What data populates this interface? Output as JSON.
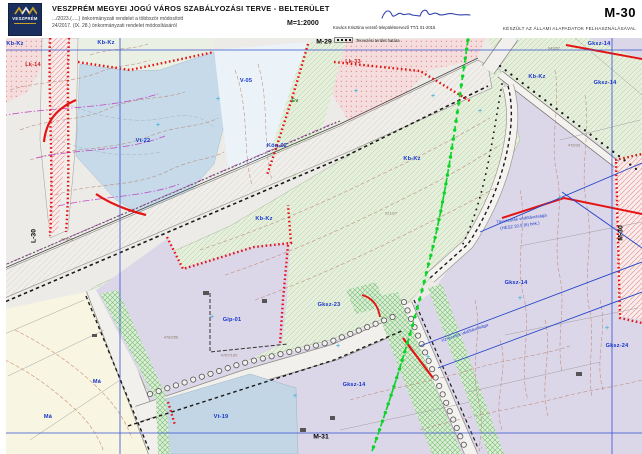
{
  "header": {
    "logo_text": "VESZPRÉM",
    "title": "VESZPRÉM MEGYEI JOGÚ VÁROS SZABÁLYOZÁSI TERVE   -   BELTERÜLET",
    "subtitle1": ".../2023.(.....) önkormányzati rendelet a többször módosított",
    "subtitle2": "24/2017. (IX. 28.) önkormányzati rendelet módosításáról",
    "scale": "M=1:2000",
    "planner": "Kovács Krisztina vezető településtervező   TT/1 01-2015",
    "legend_label": "Tervezési terület határa",
    "sheet_code": "M-30",
    "credit": "KÉSZÜLT AZ ÁLLAMI ALAPADATOK FELHASZNÁLÁSÁVAL"
  },
  "sheet_refs": [
    {
      "text": "M-29",
      "x": 324,
      "y": 42,
      "rot": 0
    },
    {
      "text": "M-31",
      "x": 321,
      "y": 437,
      "rot": 0
    },
    {
      "text": "L-30",
      "x": 34,
      "y": 236,
      "rot": -90
    },
    {
      "text": "M-30",
      "x": 621,
      "y": 233,
      "rot": -90
    }
  ],
  "zone_labels": [
    {
      "text": "Kb-Kz",
      "x": 15,
      "y": 44,
      "c": "blue"
    },
    {
      "text": "Kb-Kz",
      "x": 106,
      "y": 43,
      "c": "blue"
    },
    {
      "text": "Lk-14",
      "x": 33,
      "y": 65,
      "c": "red"
    },
    {
      "text": "Vt-22",
      "x": 143,
      "y": 141,
      "c": "blue"
    },
    {
      "text": "V-05",
      "x": 246,
      "y": 81,
      "c": "blue"
    },
    {
      "text": "Lk-33",
      "x": 353,
      "y": 62,
      "c": "red"
    },
    {
      "text": "Ev",
      "x": 295,
      "y": 101,
      "c": "green"
    },
    {
      "text": "Köu-02",
      "x": 277,
      "y": 146,
      "c": "blue"
    },
    {
      "text": "Kb-Kz",
      "x": 264,
      "y": 219,
      "c": "blue"
    },
    {
      "text": "Kb-Kz",
      "x": 412,
      "y": 159,
      "c": "blue"
    },
    {
      "text": "Kb-Kz",
      "x": 537,
      "y": 77,
      "c": "blue"
    },
    {
      "text": "Gksz-14",
      "x": 599,
      "y": 44,
      "c": "blue"
    },
    {
      "text": "Gksz-14",
      "x": 605,
      "y": 83,
      "c": "blue"
    },
    {
      "text": "Gksz-23",
      "x": 329,
      "y": 305,
      "c": "blue"
    },
    {
      "text": "Gip-01",
      "x": 232,
      "y": 320,
      "c": "blue"
    },
    {
      "text": "Gksz-14",
      "x": 354,
      "y": 385,
      "c": "blue"
    },
    {
      "text": "Gksz-14",
      "x": 516,
      "y": 283,
      "c": "blue"
    },
    {
      "text": "Gksz-24",
      "x": 617,
      "y": 346,
      "c": "blue"
    },
    {
      "text": "Vt-19",
      "x": 221,
      "y": 417,
      "c": "blue"
    },
    {
      "text": "Má",
      "x": 97,
      "y": 382,
      "c": "blue"
    },
    {
      "text": "Má",
      "x": 48,
      "y": 417,
      "c": "blue"
    }
  ],
  "annotations": [
    {
      "text": "Távvezeték védőtávolsága",
      "x": 496,
      "y": 216,
      "rot": -8
    },
    {
      "text": "(HÉSZ 20.§ (6) bek.)",
      "x": 500,
      "y": 223,
      "rot": -8
    },
    {
      "text": "vízvezeték védőtávolsága",
      "x": 440,
      "y": 330,
      "rot": -19
    }
  ],
  "parcel_labels": [
    {
      "text": "478/256",
      "x": 171,
      "y": 337
    },
    {
      "text": "4767/160",
      "x": 229,
      "y": 355
    },
    {
      "text": "476/33",
      "x": 574,
      "y": 145
    },
    {
      "text": "043/57",
      "x": 554,
      "y": 48
    },
    {
      "text": "478/56",
      "x": 67,
      "y": 239
    },
    {
      "text": "0213/7",
      "x": 391,
      "y": 213
    }
  ],
  "survey_marks": [
    {
      "x": 158,
      "y": 126
    },
    {
      "x": 218,
      "y": 100
    },
    {
      "x": 356,
      "y": 92
    },
    {
      "x": 433,
      "y": 97
    },
    {
      "x": 480,
      "y": 112
    },
    {
      "x": 212,
      "y": 318
    },
    {
      "x": 338,
      "y": 347
    },
    {
      "x": 295,
      "y": 397
    },
    {
      "x": 428,
      "y": 358
    },
    {
      "x": 520,
      "y": 299
    },
    {
      "x": 560,
      "y": 199
    },
    {
      "x": 607,
      "y": 329
    }
  ],
  "colors": {
    "zone_label_blue": "#1535cc",
    "zone_label_red": "#cc2020",
    "zone_label_green": "#2a7a2a",
    "grid_blue": "#3352d0",
    "regulation_red": "#e51414",
    "planning_boundary_green": "#0ed42a",
    "residential_pink": "#f5dddd",
    "commercial_lavender": "#dcd6e9",
    "water_blue": "#c6dae9",
    "agricultural_cream": "#f8f5e2",
    "green_zone": "#e6efdc"
  }
}
